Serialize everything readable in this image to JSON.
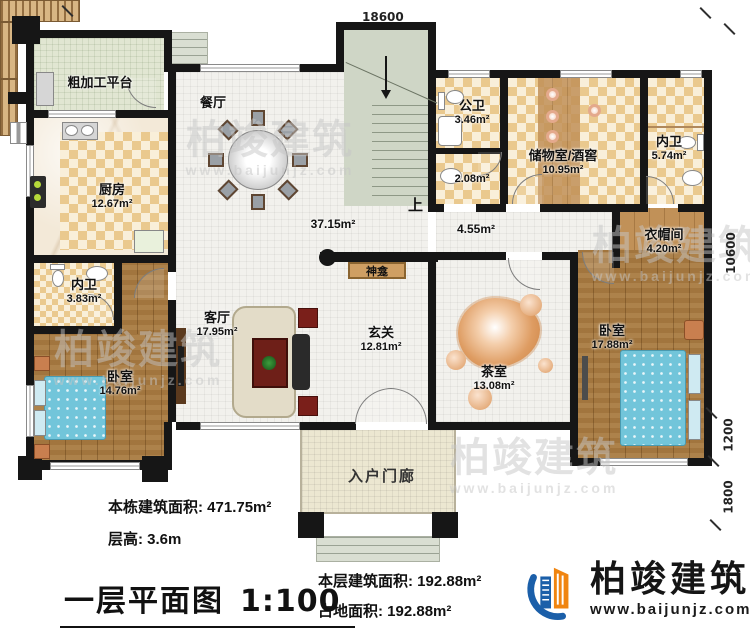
{
  "title": {
    "name": "一层平面图",
    "scale": "1:100"
  },
  "stats": {
    "total_area": "本栋建筑面积: 471.75m²",
    "floor_height": "层高: 3.6m",
    "floor_area": "本层建筑面积: 192.88m²",
    "footprint": "占地面积: 192.88m²"
  },
  "brand": {
    "name": "柏竣建筑",
    "website": "www.baijunjz.com"
  },
  "watermark": {
    "name": "柏竣建筑",
    "website": "www.baijunjz.com"
  },
  "dimensions": {
    "top": "18600",
    "right_total": "10600",
    "right_mid": "1200",
    "right_bottom": "1800"
  },
  "rooms": {
    "platform": {
      "name": "粗加工平台"
    },
    "dining": {
      "name": "餐厅"
    },
    "kitchen": {
      "name": "厨房",
      "area": "12.67m²"
    },
    "bath_inner_left": {
      "name": "内卫",
      "area": "3.83m²"
    },
    "bedroom_left": {
      "name": "卧室",
      "area": "14.76m²"
    },
    "living": {
      "name": "客厅",
      "area": "17.95m²"
    },
    "bath_public": {
      "name": "公卫",
      "area": "3.46m²"
    },
    "storage_cellar": {
      "name": "储物室/酒窖",
      "area": "10.95m²"
    },
    "bath_inner_right": {
      "name": "内卫",
      "area": "5.74m²"
    },
    "cloakroom": {
      "name": "衣帽间",
      "area": "4.20m²"
    },
    "bedroom_right": {
      "name": "卧室",
      "area": "17.88m²"
    },
    "foyer": {
      "name": "玄关",
      "area": "12.81m²"
    },
    "tea_room": {
      "name": "茶室",
      "area": "13.08m²"
    },
    "porch": {
      "name": "入户门廊"
    }
  },
  "labels": {
    "open_area": "37.15m²",
    "corridor_area": "4.55m²",
    "wash_area": "2.08m²",
    "up": "上",
    "shrine": "神龛"
  }
}
